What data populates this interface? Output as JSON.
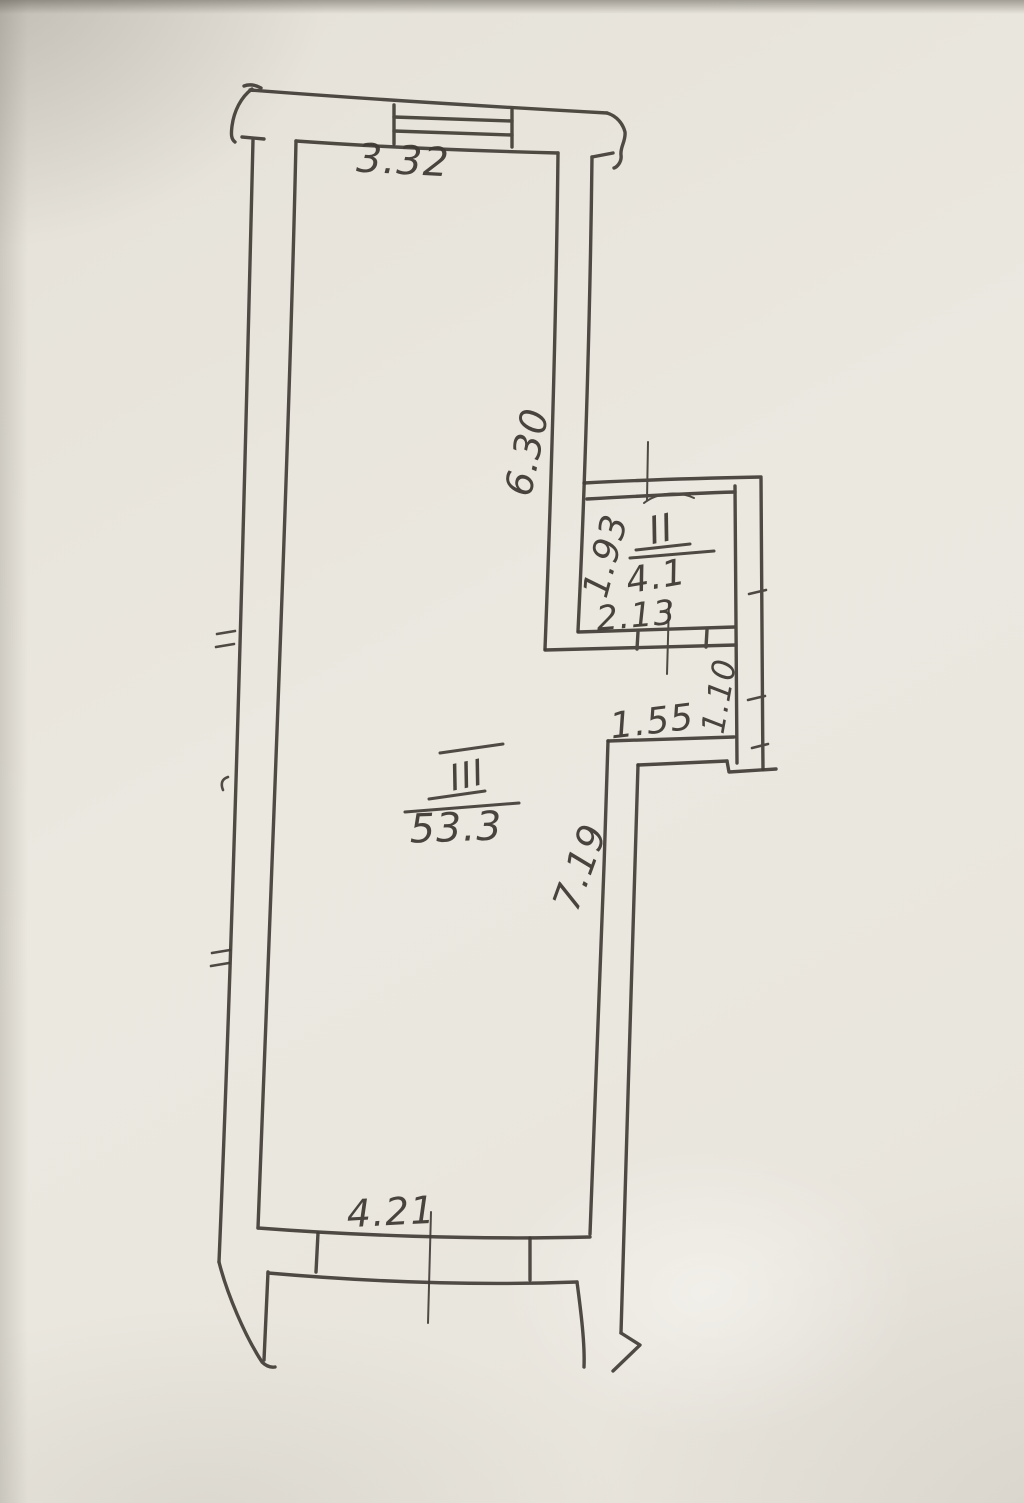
{
  "plan": {
    "description": "hand-drawn apartment floor plan sketch on paper",
    "ink_color": "#413d36",
    "paper_color": "#e9e6de",
    "rooms": [
      {
        "numeral": "II",
        "area": "4.1"
      },
      {
        "numeral": "III",
        "area": "53.3"
      }
    ],
    "dimensions": {
      "top_width": "3.32",
      "upper_right_wall": "6.30",
      "room2_left": "1.93",
      "room2_bottom": "2.13",
      "alcove_width": "1.55",
      "alcove_depth": "1.10",
      "lower_right_wall": "7.19",
      "bottom_width": "4.21"
    }
  }
}
